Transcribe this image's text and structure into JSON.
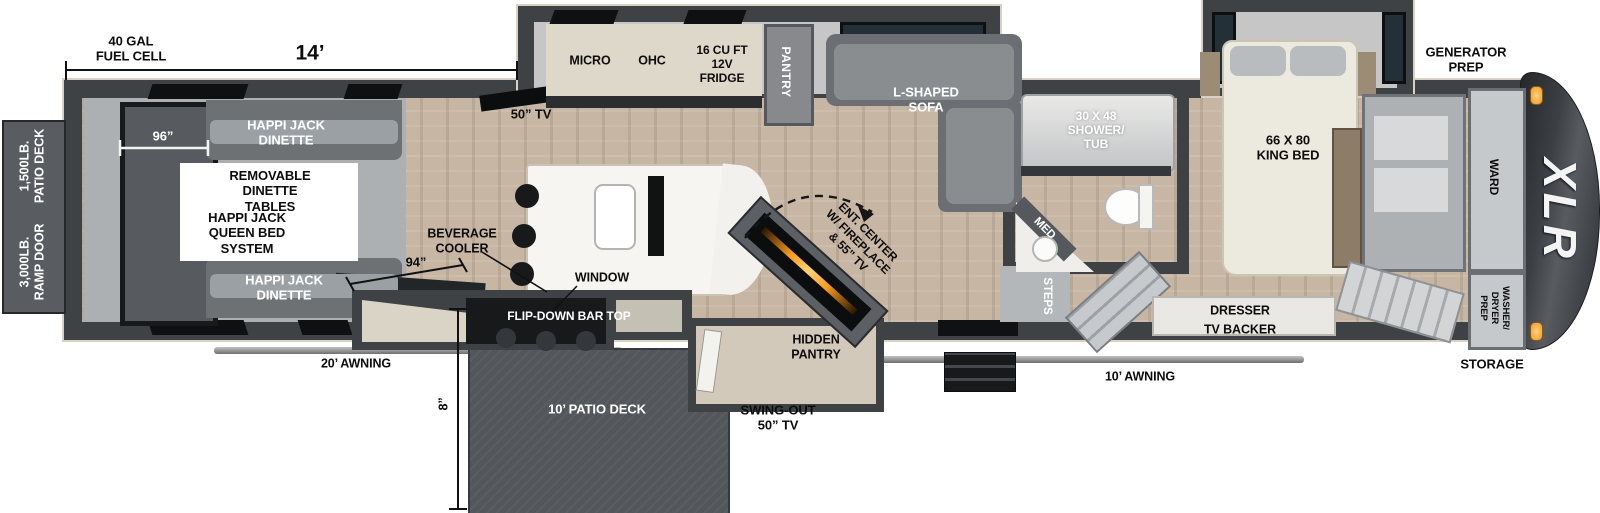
{
  "labels": {
    "fuel_cell": "40 GAL\nFUEL CELL",
    "garage_length": "14’",
    "patio_deck_rating": "1,500LB.\nPATIO DECK",
    "ramp_door_rating": "3,000LB.\nRAMP DOOR",
    "garage_width": "96”",
    "dinette_front": "HAPPI JACK\nDINETTE",
    "dinette_rear": "HAPPI JACK\nDINETTE",
    "removable_tables": "REMOVABLE\nDINETTE\nTABLES",
    "queen_bed_system": "HAPPI JACK\nQUEEN BED\nSYSTEM",
    "garage_tv": "50” TV",
    "micro": "MICRO",
    "ohc": "OHC",
    "fridge": "16 CU FT\n12V\nFRIDGE",
    "pantry": "PANTRY",
    "sofa": "L-SHAPED\nSOFA",
    "beverage_cooler": "BEVERAGE\nCOOLER",
    "counter_length": "94”",
    "window": "WINDOW",
    "awning_rear": "20’ AWNING",
    "flip_down_bar": "FLIP-DOWN BAR TOP",
    "deck_height": "8”",
    "patio_deck": "10’ PATIO DECK",
    "swing_out_tv": "SWING-OUT\n50” TV",
    "hidden_pantry": "HIDDEN\nPANTRY",
    "ent_center": "ENT. CENTER\nW/ FIREPLACE\n& 55” TV",
    "med": "MED",
    "steps": "STEPS",
    "shower": "30 X 48\nSHOWER/\nTUB",
    "awning_main": "10’ AWNING",
    "king_bed": "66 X 80\nKING BED",
    "dresser": "DRESSER",
    "tv_backer": "TV BACKER",
    "generator_prep": "GENERATOR\nPREP",
    "ward": "WARD",
    "washer_dryer_prep": "WASHER/\nDRYER\nPREP",
    "storage": "STORAGE",
    "brand": "XLR"
  },
  "colors": {
    "wall": "#3f4245",
    "trim": "#d9d2c4",
    "floor_wood": "#c6b6a3",
    "slide_floor": "#c6c6c6",
    "marker_light": "#f2a237",
    "deck": "#53575c"
  }
}
